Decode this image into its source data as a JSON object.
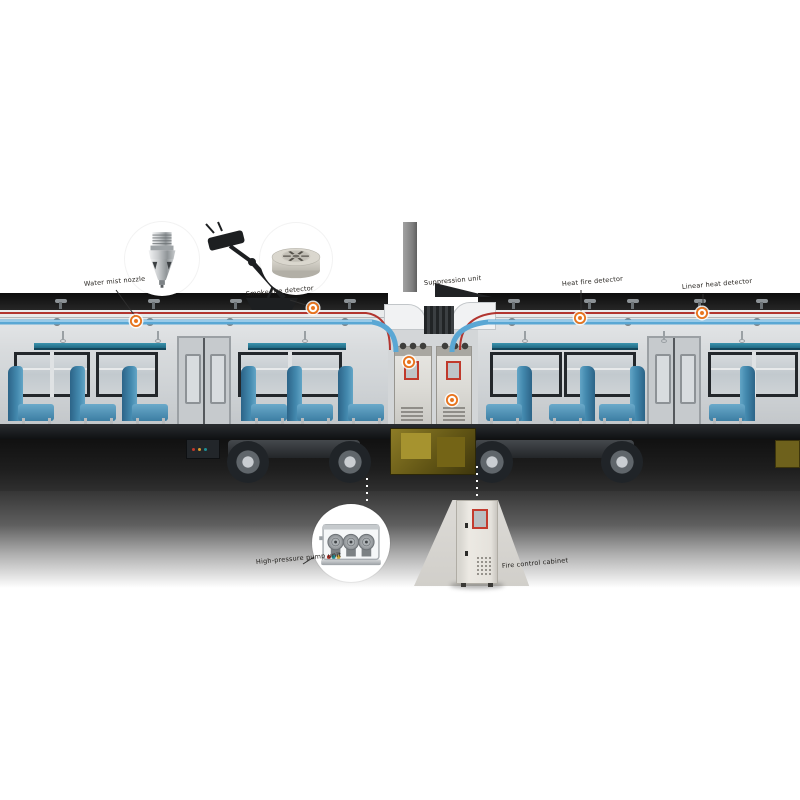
{
  "labels": {
    "nozzle": "Water mist nozzle",
    "smoke_detector": "Smoke fire detector",
    "suppression_unit": "Suppression unit",
    "heat_detector": "Heat fire detector",
    "linear_heat_detector": "Linear heat detector",
    "pump_unit": "High-pressure pump unit",
    "control_cabinet": "Fire control cabinet"
  },
  "icons": {
    "nozzle_photo": "water-mist-nozzle",
    "smoke_detector_photo": "round-smoke-detector",
    "pump_module_photo": "pump-module-in-case",
    "control_cabinet_photo": "floor-standing-control-cabinet",
    "hotspot": "orange-ring-marker"
  },
  "colors": {
    "hotspot_orange": "#e8731c",
    "pipe_blue": "#5aa7d4",
    "pipe_red": "#b23530",
    "seat_blue": "#3b7fa6",
    "rack_teal": "#2a7e99",
    "screen_red": "#c0392b",
    "shadow": "#161616"
  }
}
